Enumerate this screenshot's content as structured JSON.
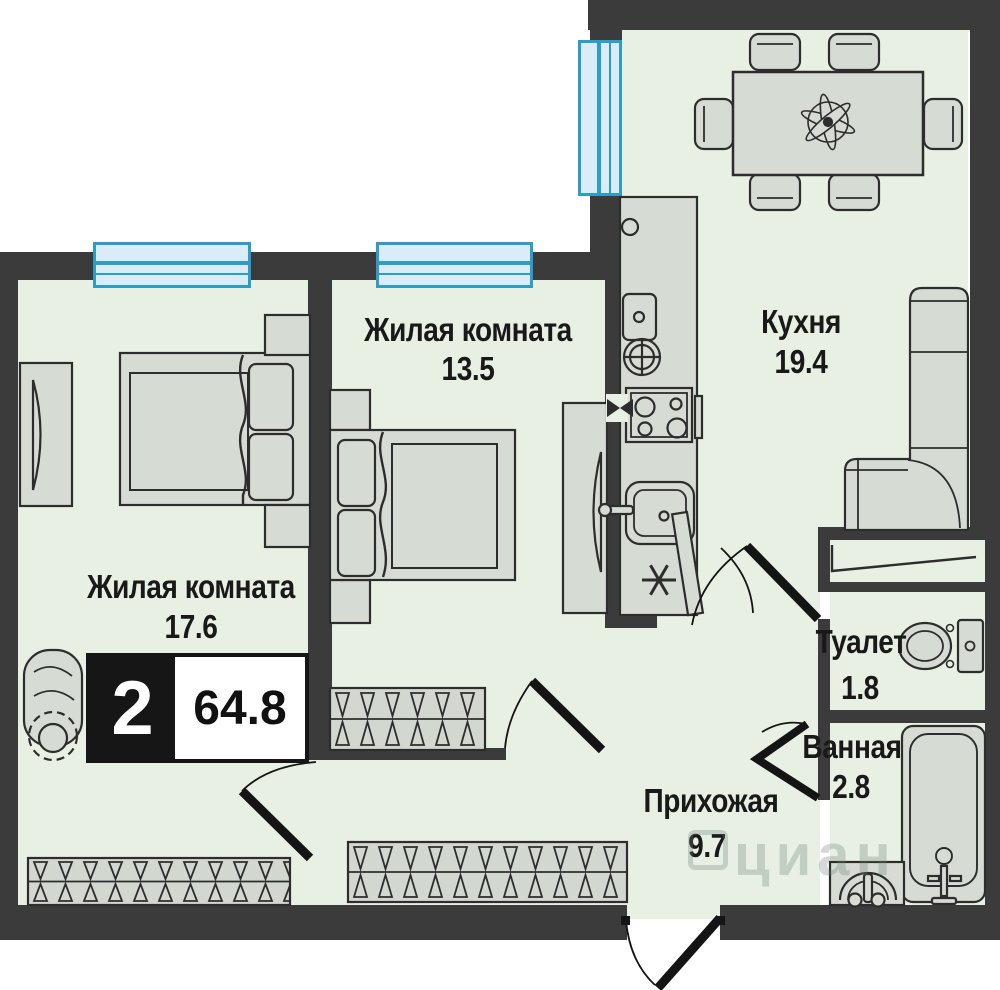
{
  "plan": {
    "badge": {
      "rooms": "2",
      "total_area": "64.8"
    },
    "rooms": [
      {
        "id": "living-room-1",
        "label": "Жилая комната",
        "area": "17.6"
      },
      {
        "id": "living-room-2",
        "label": "Жилая комната",
        "area": "13.5"
      },
      {
        "id": "kitchen",
        "label": "Кухня",
        "area": "19.4"
      },
      {
        "id": "hallway",
        "label": "Прихожая",
        "area": "9.7"
      },
      {
        "id": "toilet",
        "label": "Туалет",
        "area": "1.8"
      },
      {
        "id": "bathroom",
        "label": "Ванная",
        "area": "2.8"
      }
    ],
    "watermark": {
      "brand": "циан"
    },
    "colors": {
      "floor": "#e7f0e2",
      "wall": "#3b3b3c",
      "furn": "#d6dbd3",
      "stroke": "#2d2d2d",
      "window": "#2e9cc9",
      "window-fill": "#d9ecf7",
      "text": "#191919"
    }
  }
}
